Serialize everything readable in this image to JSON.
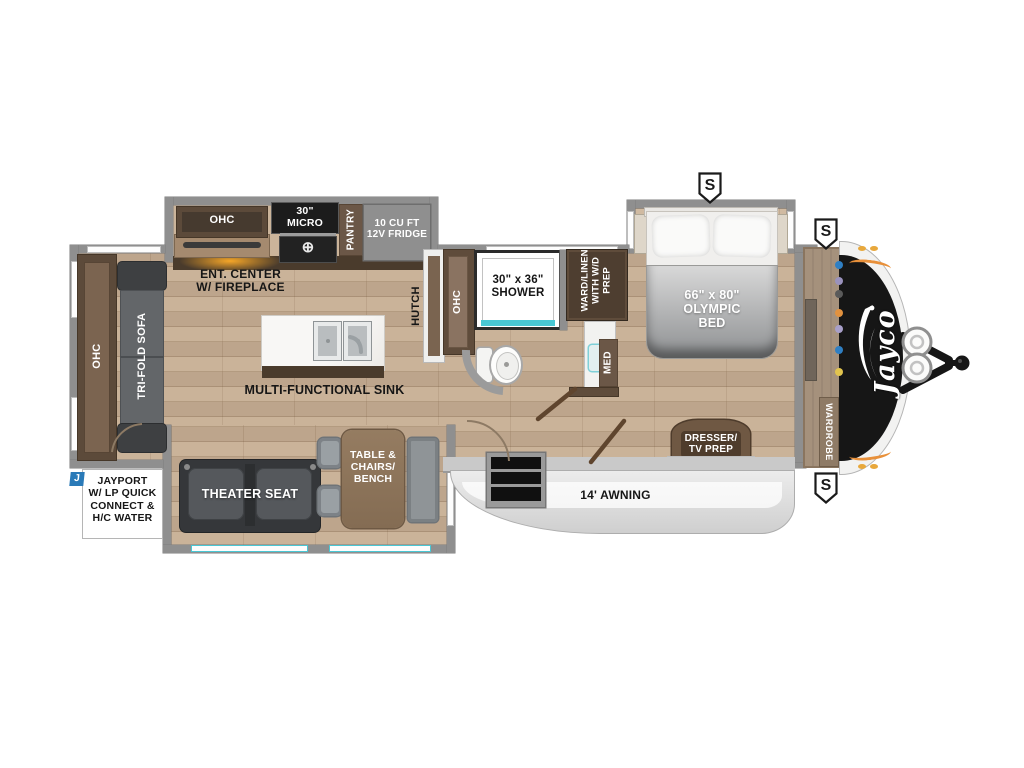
{
  "plan_type": "travel-trailer-floorplan",
  "brand": {
    "logo": "Jayco"
  },
  "badges": {
    "s": "S",
    "j": "J"
  },
  "rear": {
    "ohc": "OHC",
    "sofa": "TRI-FOLD SOFA"
  },
  "kitchen": {
    "ohc": "OHC",
    "micro": "30\"\nMICRO",
    "burner": "⊕",
    "pantry": "PANTRY",
    "fridge": "10 CU FT\n12V FRIDGE",
    "ent_center": "ENT. CENTER\nW/ FIREPLACE",
    "island_sink": "MULTI-FUNCTIONAL SINK"
  },
  "bath": {
    "hutch": "HUTCH",
    "ohc": "OHC",
    "shower": "30\" x 36\"\nSHOWER",
    "ward": "WARD/LINEN\nWITH W/D\nPREP",
    "med": "MED"
  },
  "bedroom": {
    "bed": "66\" x 80\"\nOLYMPIC\nBED",
    "dresser": "DRESSER/\nTV PREP",
    "wardrobe": "WARDROBE"
  },
  "living": {
    "theater_seat": "THEATER SEAT",
    "dinette": "TABLE &\nCHAIRS/\nBENCH"
  },
  "exterior": {
    "awning": "14' AWNING",
    "jayport": "JAYPORT\nW/ LP QUICK\nCONNECT &\nH/C WATER"
  },
  "colors": {
    "floor_wood": "#c7ae93",
    "wall_gray": "#8f8f8f",
    "cabinet_brown": "#7b6450",
    "accent_teal": "#49c7d4",
    "badge_blue": "#2a7ab8",
    "cap_black": "#161616",
    "awning_gray": "#d8d8d8",
    "glow_orange": "#f0a13c",
    "front_dots": [
      "#2f7fc3",
      "#9a92bd",
      "#5a5a5a",
      "#e2923f",
      "#a89fc9",
      "#2f7fc3",
      "#e2c44e"
    ]
  }
}
